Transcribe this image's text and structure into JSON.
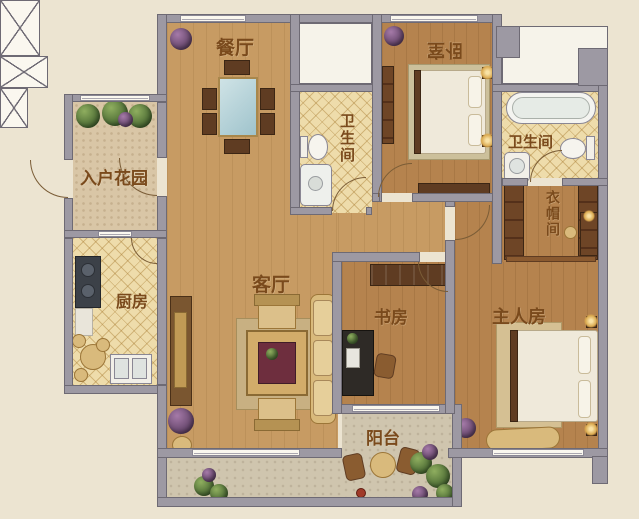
{
  "plan": {
    "type": "apartment-floor-plan",
    "rooms": {
      "dining": {
        "label": "餐厅",
        "orientation": "horizontal"
      },
      "entrance_garden": {
        "label": "入户花园",
        "orientation": "horizontal"
      },
      "kitchen": {
        "label": "厨房",
        "orientation": "horizontal"
      },
      "living": {
        "label": "客厅",
        "orientation": "horizontal"
      },
      "bathroom_1": {
        "label": "卫生间",
        "orientation": "vertical"
      },
      "bedroom": {
        "label": "卧室",
        "orientation": "rotated-180"
      },
      "bathroom_2": {
        "label": "卫生间",
        "orientation": "horizontal"
      },
      "closet": {
        "label": "衣帽间",
        "orientation": "vertical"
      },
      "study": {
        "label": "书房",
        "orientation": "horizontal"
      },
      "master_bedroom": {
        "label": "主人房",
        "orientation": "horizontal"
      },
      "balcony": {
        "label": "阳台",
        "orientation": "horizontal"
      }
    }
  },
  "colors": {
    "wall": "#9d99a3",
    "wall_edge": "#6e6a74",
    "background": "#ece4d1",
    "wood_light": "#c79b63",
    "wood_dark": "#b5834e",
    "tile": "#eedcab",
    "garden_floor": "#d9c6a6",
    "balcony_floor": "#cfc5ae",
    "window_fill": "#faf7ef",
    "label_text": "#7a4a1c",
    "dark_wood": "#5f3c22",
    "gold": "#d9ba7c"
  }
}
